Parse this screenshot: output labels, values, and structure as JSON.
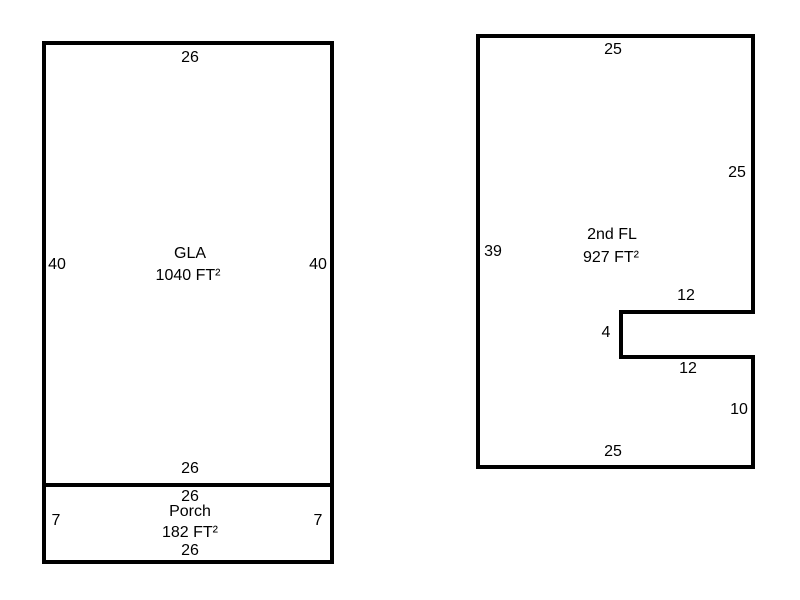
{
  "colors": {
    "background": "#ffffff",
    "line": "#000000",
    "text": "#000000"
  },
  "left_building": {
    "gla": {
      "name": "GLA",
      "area": "1040 FT²",
      "dim_top": "26",
      "dim_left": "40",
      "dim_right": "40",
      "dim_bottom": "26"
    },
    "porch": {
      "name": "Porch",
      "area": "182 FT²",
      "dim_top": "26",
      "dim_left": "7",
      "dim_right": "7",
      "dim_bottom": "26"
    }
  },
  "right_building": {
    "second_floor": {
      "name": "2nd FL",
      "area": "927 FT²",
      "dim_top": "25",
      "dim_right_upper": "25",
      "dim_left": "39",
      "dim_notch_top": "12",
      "dim_notch_left": "4",
      "dim_notch_bottom": "12",
      "dim_right_lower": "10",
      "dim_bottom": "25"
    }
  }
}
